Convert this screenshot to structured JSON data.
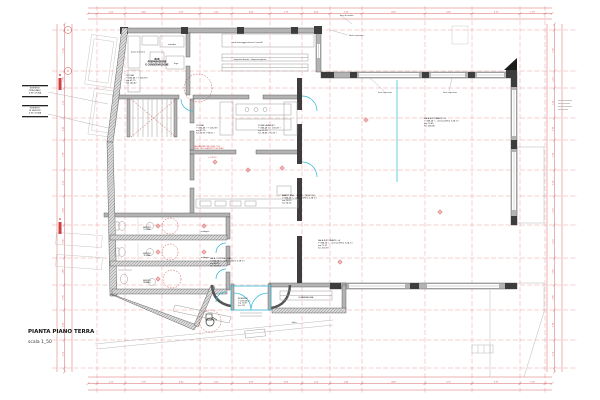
{
  "sheet": {
    "title": "PIANTA PIANO TERRA",
    "scale_label": "scala 1_50",
    "bg": "#ffffff"
  },
  "colors": {
    "dim_red": "#cf4040",
    "grid_red": "#e79a9a",
    "wall_gray": "#b3b3b3",
    "wall_dark": "#3d3d3d",
    "furniture_gray": "#9c9c9c",
    "glass_cyan": "#2ab5d6",
    "text_black": "#1c1c1c"
  },
  "grid": {
    "vxs": [
      97,
      125,
      162,
      200,
      232,
      270,
      302,
      330,
      362,
      425,
      472,
      520,
      545
    ],
    "hys": [
      30,
      71,
      88,
      118,
      140,
      170,
      196,
      225,
      258,
      285,
      310,
      340,
      368
    ]
  },
  "dims": {
    "top": [
      "1,20",
      "3,45",
      "2,90",
      "1,50",
      "3,60",
      "2,75",
      "4,05",
      "2,35",
      "4,90",
      "3,65",
      "3,70",
      "1,95"
    ],
    "bottom": [
      "2,10",
      "2,95",
      "3,40",
      "2,50",
      "2,95",
      "3,05",
      "2,20",
      "2,45",
      "4,85",
      "3,70",
      "3,75",
      "1,90"
    ],
    "left": [
      "1,45",
      "2,30",
      "1,15",
      "2,40",
      "1,70",
      "2,25",
      "2,05",
      "2,30",
      "2,60",
      "1,95",
      "2,35",
      "2,15"
    ],
    "right": [
      "1,50",
      "2,25",
      "1,20",
      "2,35",
      "1,75",
      "2,20",
      "2,10",
      "2,25",
      "2,55",
      "2,00",
      "2,30",
      "2,10"
    ]
  },
  "bubbles": [
    {
      "x": 68,
      "y": 30,
      "label": "1"
    },
    {
      "x": 68,
      "y": 71,
      "label": "2"
    }
  ],
  "sections": [
    {
      "x": 60,
      "y": 84,
      "label": "B"
    },
    {
      "x": 60,
      "y": 228,
      "label": "A"
    }
  ],
  "targets": [
    [
      215,
      162
    ],
    [
      248,
      170
    ],
    [
      158,
      226
    ],
    [
      204,
      226
    ],
    [
      158,
      252
    ],
    [
      204,
      252
    ],
    [
      158,
      279
    ],
    [
      282,
      168
    ],
    [
      340,
      262
    ],
    [
      440,
      212
    ],
    [
      366,
      120
    ]
  ],
  "labels": [
    {
      "id": "title",
      "x": 28,
      "y": 333,
      "size": 5.5,
      "align": "start",
      "bold": true,
      "color": "#111111",
      "lines": [
        "PIANTA PIANO TERRA"
      ]
    },
    {
      "id": "scale",
      "x": 28,
      "y": 343,
      "size": 4.5,
      "align": "start",
      "bold": false,
      "color": "#333333",
      "lines": [
        "scala 1_50"
      ]
    },
    {
      "id": "legend-1",
      "x": 35,
      "y": 88.5,
      "size": 2.0,
      "align": "middle",
      "lines": [
        "INGRESSO",
        "PRINCIPALE",
        "4 IN CUCINA"
      ]
    },
    {
      "id": "legend-2",
      "x": 35,
      "y": 108.5,
      "size": 2.0,
      "align": "middle",
      "lines": [
        "INGRESSO",
        "DI SERVIZIO",
        "4 IN CUCINA"
      ]
    },
    {
      "id": "room-bar-prep",
      "x": 157,
      "y": 60,
      "size": 2.2,
      "align": "middle",
      "bold": true,
      "lines": [
        "BAR",
        "PREPARAZIONE",
        "E CONSERVAZIONE"
      ]
    },
    {
      "id": "note-piano-lavoro",
      "x": 138,
      "y": 52.5,
      "size": 1.9,
      "align": "middle",
      "lines": [
        "piano di lavoro"
      ]
    },
    {
      "id": "note-armadio",
      "x": 172,
      "y": 45,
      "size": 1.9,
      "align": "middle",
      "lines": [
        "armadio"
      ]
    },
    {
      "id": "note-frigo",
      "x": 176,
      "y": 64,
      "size": 1.9,
      "align": "middle",
      "lines": [
        "frigo"
      ]
    },
    {
      "id": "room-cucina-1",
      "x": 126,
      "y": 76,
      "size": 2.0,
      "align": "start",
      "lines": [
        "CUCINA",
        "+ 386,48 ( + 105,09 )",
        "mq 41,79",
        "h= 143,82"
      ]
    },
    {
      "id": "note-stoccaggio",
      "x": 247,
      "y": 43,
      "size": 1.9,
      "align": "middle",
      "lines": [
        "zona stoccaggio attrezzi / carrelli"
      ]
    },
    {
      "id": "note-deposito",
      "x": 250,
      "y": 60,
      "size": 1.9,
      "align": "middle",
      "lines": [
        "deposito derrate - dispensa giorno"
      ]
    },
    {
      "id": "room-cucina-2",
      "x": 196,
      "y": 126,
      "size": 2.0,
      "align": "start",
      "lines": [
        "CUCINA",
        "+ 386,48 ( + 105,09 )",
        "mq 31,75",
        "h= 45,39 ( 98,92 )"
      ]
    },
    {
      "id": "room-zona-lavaggio",
      "x": 258,
      "y": 126,
      "size": 2.0,
      "align": "start",
      "lines": [
        "ZONA LAVAGGIO",
        "+ 386,48 m ( 105,09 )",
        "mq 11,93",
        "h= 28,86 ( 15,39 )"
      ]
    },
    {
      "id": "note-paving",
      "x": 194,
      "y": 147,
      "size": 1.8,
      "align": "start",
      "color": "#cf4040",
      "lines": [
        "PAVIMENTAZIONE GRES CON",
        "PEND. PER QUADROTTI SIFONATI"
      ]
    },
    {
      "id": "note-quota",
      "x": 208,
      "y": 158,
      "size": 1.8,
      "align": "start",
      "color": "#cf4040",
      "lines": [
        "+ 105,30"
      ]
    },
    {
      "id": "room-banco-bar",
      "x": 282,
      "y": 196,
      "size": 2.0,
      "align": "start",
      "lines": [
        "BANCO BAR - CASSA - TELEFONO",
        "+ 386,08 ( - controsoffitto 5,28 m )",
        "mq 18,15",
        "h= 54,30"
      ]
    },
    {
      "id": "room-sala-cottura",
      "x": 210,
      "y": 259,
      "size": 2.0,
      "align": "start",
      "lines": [
        "SALA COTTURA - BAR",
        "+ 386,08 ( - controsoffitto 5,28 m )",
        "mq 48,15",
        "h= 313,93"
      ]
    },
    {
      "id": "room-sala-a",
      "x": 318,
      "y": 241,
      "size": 2.0,
      "align": "start",
      "lines": [
        "SALA RISTORANTE - A",
        "+ 386,08 ( - controsoffitto 5,28 m )",
        "mq 71,31",
        "h= 313,93"
      ]
    },
    {
      "id": "room-sala-b",
      "x": 424,
      "y": 119,
      "size": 2.0,
      "align": "start",
      "lines": [
        "SALA RISTORANTE - B",
        "+ 386,08 ( - controsoffitto 5,28 m )",
        "mq 72,85",
        "h= 318,08"
      ]
    },
    {
      "id": "room-ingresso",
      "x": 238,
      "y": 299,
      "size": 1.9,
      "align": "start",
      "lines": [
        "INGRESSO",
        "+ 236,08 cm",
        "mq 11,87",
        "h= 315"
      ]
    },
    {
      "id": "room-guardaroba",
      "x": 306,
      "y": 298,
      "size": 2.1,
      "align": "middle",
      "lines": [
        "GUARDAROBA"
      ]
    },
    {
      "id": "note-salita",
      "x": 294,
      "y": 323,
      "size": 1.8,
      "align": "middle",
      "lines": [
        "salita"
      ]
    },
    {
      "id": "room-wc-1",
      "x": 147,
      "y": 228,
      "size": 1.8,
      "align": "middle",
      "lines": [
        "SERVIZIO",
        "UOMINI"
      ]
    },
    {
      "id": "room-wc-2",
      "x": 147,
      "y": 254,
      "size": 1.8,
      "align": "middle",
      "lines": [
        "SERVIZIO",
        "DONNE"
      ]
    },
    {
      "id": "room-wc-3",
      "x": 147,
      "y": 281,
      "size": 1.8,
      "align": "middle",
      "lines": [
        "SERVIZIO",
        "DISABILI"
      ]
    },
    {
      "id": "note-antibagno-1",
      "x": 205,
      "y": 232,
      "size": 1.7,
      "align": "middle",
      "lines": [
        "antibagno"
      ]
    },
    {
      "id": "note-antibagno-2",
      "x": 205,
      "y": 258,
      "size": 1.7,
      "align": "middle",
      "lines": [
        "antibagno"
      ]
    },
    {
      "id": "note-confine",
      "x": 340,
      "y": 16,
      "size": 1.8,
      "align": "start",
      "lines": [
        "linea di confine"
      ]
    },
    {
      "id": "note-limite",
      "x": 349,
      "y": 36,
      "size": 1.8,
      "align": "start",
      "lines": [
        "limite copertura"
      ]
    },
    {
      "id": "note-roof-1",
      "x": 378,
      "y": 93,
      "size": 1.8,
      "align": "start",
      "lines": [
        "linea copertura"
      ]
    },
    {
      "id": "note-roof-2",
      "x": 443,
      "y": 93,
      "size": 1.8,
      "align": "start",
      "lines": [
        "linea copertura"
      ]
    }
  ]
}
